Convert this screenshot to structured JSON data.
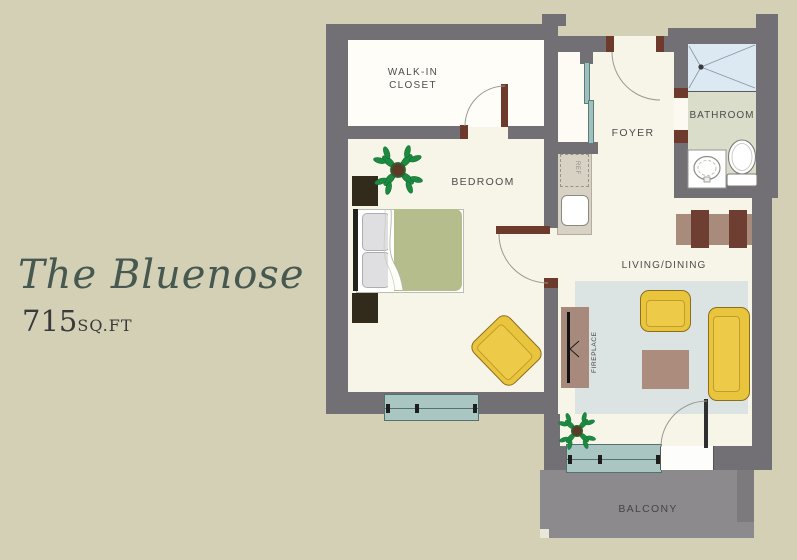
{
  "title": {
    "name": "The Bluenose",
    "area_number": "715",
    "area_unit": "SQ.FT"
  },
  "rooms": {
    "walk_in_closet": "WALK-IN\nCLOSET",
    "bedroom": "BEDROOM",
    "foyer": "FOYER",
    "bathroom": "BATHROOM",
    "living_dining": "LIVING/DINING",
    "balcony": "BALCONY",
    "fireplace": "FIREPLACE",
    "refrigerator": "REF"
  },
  "furniture": [
    "bed",
    "pillows",
    "nightstands",
    "bedroom-armchair",
    "plant",
    "closet-door",
    "refrigerator",
    "kitchen-sink",
    "shower",
    "vanity-sink",
    "toilet",
    "dining-table",
    "dining-chairs",
    "living-armchair",
    "sofa",
    "coffee-table",
    "fireplace",
    "rug",
    "balcony-sliding-window",
    "balcony-door",
    "bedroom-window"
  ],
  "colors": {
    "page_bg": "#d4d0b6",
    "floor_cream": "#f7f4e8",
    "closet_white": "#fffdf8",
    "wall_gray": "#727074",
    "door_trim_brown": "#6e3a2b",
    "window_teal": "#a9c6c2",
    "rug_blue": "#dce4e3",
    "furniture_yellow": "#e9c53e",
    "table_brown": "#a98b7c",
    "chair_dark_brown": "#6f3e33",
    "duvet_green": "#b6bd8c",
    "bath_floor_sage": "#d9ddc9",
    "shower_blue": "#dde9f2",
    "balcony_gray": "#8c8a8d",
    "plant_green": "#1c8a41",
    "title_green": "#46584f",
    "label_gray": "#4d4d4d"
  }
}
